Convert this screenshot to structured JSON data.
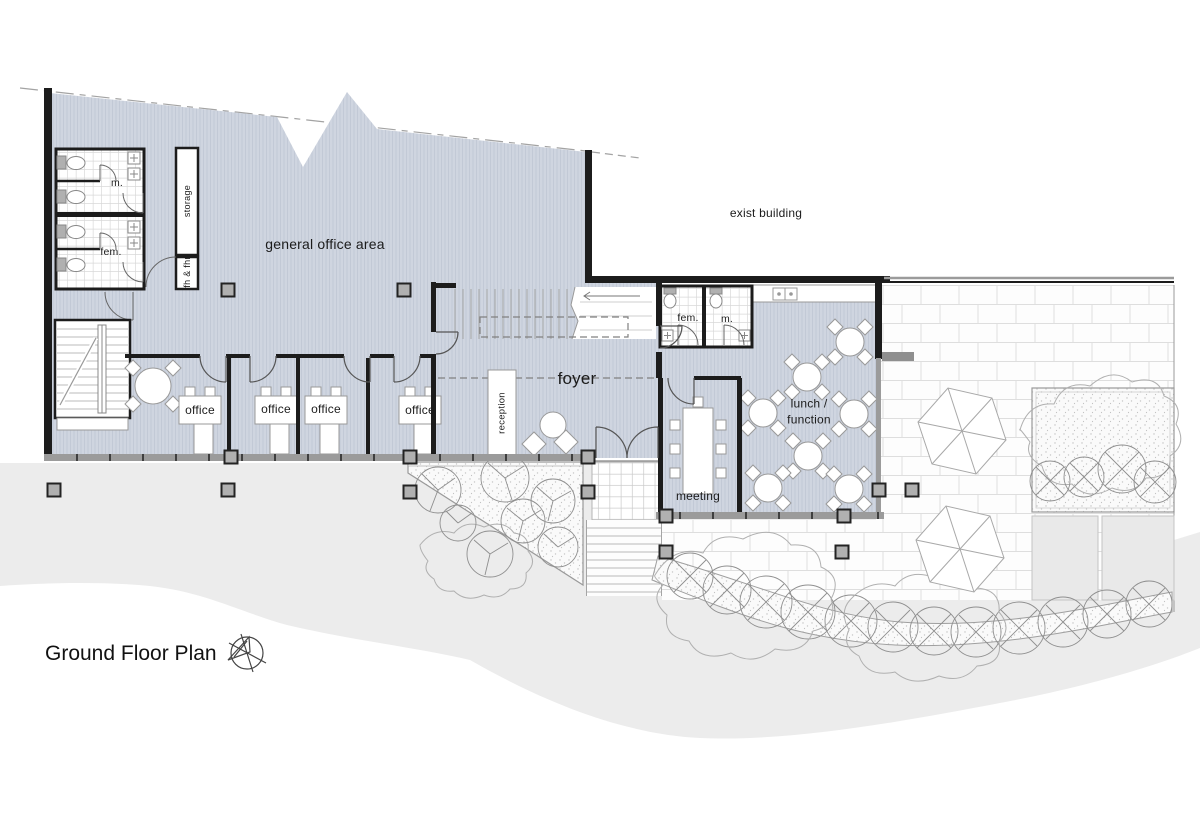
{
  "title": "Ground Floor Plan",
  "icons": {
    "north_arrow": "north-arrow"
  },
  "colors": {
    "floor_fill": "#cfd5e0",
    "floor_hatch": "#c2c9d6",
    "wall": "#1c1c1c",
    "glazing_band": "#9b9b9b",
    "column": "#b0b0b0",
    "ground_wash": "#ececec",
    "paving_joint": "#dedede",
    "landscape_line": "#a0a0a0",
    "text": "#1b1b1b"
  },
  "rooms": {
    "general_office": "general office area",
    "exist_building": "exist building",
    "male_toilet": "m.",
    "female_toilet": "fem.",
    "storage": "storage",
    "fire_hose": "fh & fhr",
    "offices": [
      "office",
      "office",
      "office",
      "office"
    ],
    "reception": "reception",
    "foyer": "foyer",
    "function_female_toilet": "fem.",
    "function_male_toilet": "m.",
    "lunch_function": "lunch / function",
    "meeting": "meeting"
  }
}
